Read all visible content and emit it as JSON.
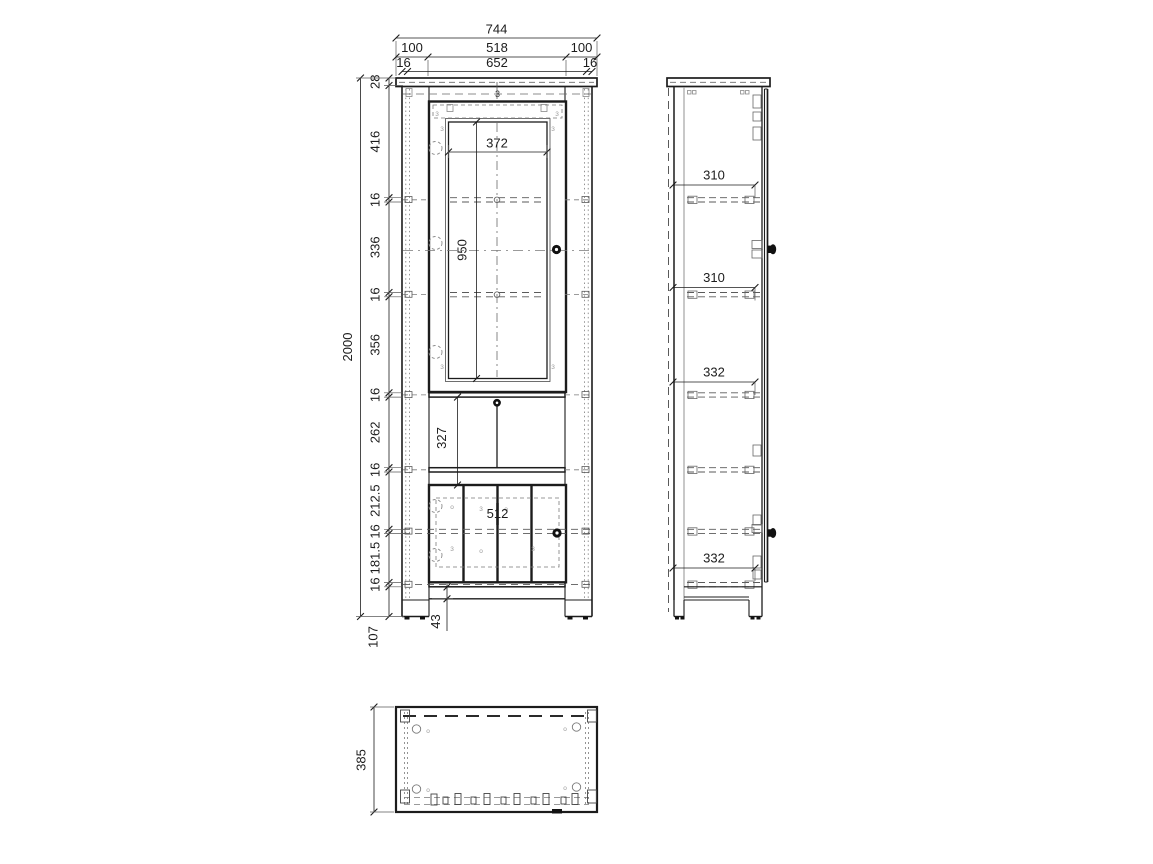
{
  "page": {
    "background": "#ffffff"
  },
  "views": {
    "front": "front-elevation",
    "side": "side-elevation",
    "top": "top-plan"
  },
  "colors": {
    "line": "#1c1c1c",
    "dash": "#5a5a5a",
    "hw": "#8a8a8a",
    "knob": "#111111"
  },
  "dims": {
    "front": {
      "total_width": "744",
      "left_inset": "100",
      "door_opening": "518",
      "right_inset": "100",
      "panel_left": "16",
      "inner_width": "652",
      "panel_right": "16",
      "chain": [
        "28",
        "416",
        "16",
        "336",
        "16",
        "356",
        "16",
        "262",
        "16",
        "212.5",
        "16",
        "181.5",
        "16"
      ],
      "total_height": "2000",
      "plinth": "107",
      "glass_width": "372",
      "glass_height": "950",
      "middle_opening": "327",
      "lower_door_width": "512",
      "apron": "43"
    },
    "side": {
      "gaps": [
        "310",
        "310",
        "332",
        "332"
      ]
    },
    "top": {
      "depth": "385"
    },
    "marks": {
      "screw": "3",
      "dot": "o"
    }
  }
}
